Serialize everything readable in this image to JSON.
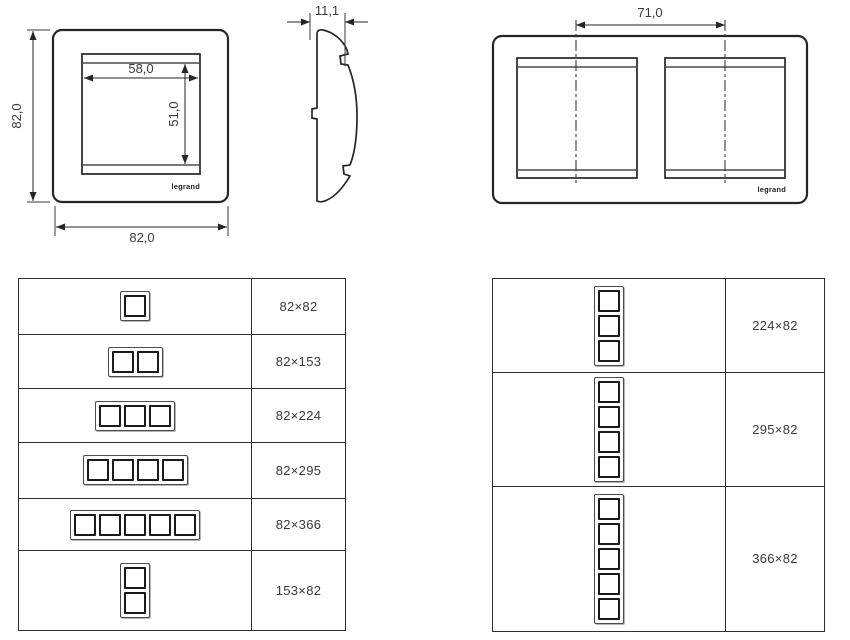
{
  "page": {
    "background": "#ffffff",
    "line_color": "#262626",
    "text_color": "#3a3a3a"
  },
  "drawings": {
    "front_single": {
      "height_label": "82,0",
      "width_label": "82,0",
      "window_width_label": "58,0",
      "window_height_label": "51,0",
      "brand_label": "legrand"
    },
    "side_profile": {
      "thickness_label": "11,1"
    },
    "front_double": {
      "centers_distance_label": "71,0",
      "brand_label": "legrand"
    }
  },
  "size_tables": {
    "horizontal": {
      "rows": [
        {
          "gangs": 1,
          "orientation": "horizontal",
          "size": "82×82"
        },
        {
          "gangs": 2,
          "orientation": "horizontal",
          "size": "82×153"
        },
        {
          "gangs": 3,
          "orientation": "horizontal",
          "size": "82×224"
        },
        {
          "gangs": 4,
          "orientation": "horizontal",
          "size": "82×295"
        },
        {
          "gangs": 5,
          "orientation": "horizontal",
          "size": "82×366"
        },
        {
          "gangs": 2,
          "orientation": "vertical",
          "size": "153×82"
        }
      ]
    },
    "vertical": {
      "rows": [
        {
          "gangs": 3,
          "orientation": "vertical",
          "size": "224×82"
        },
        {
          "gangs": 4,
          "orientation": "vertical",
          "size": "295×82"
        },
        {
          "gangs": 5,
          "orientation": "vertical",
          "size": "366×82"
        }
      ]
    }
  }
}
